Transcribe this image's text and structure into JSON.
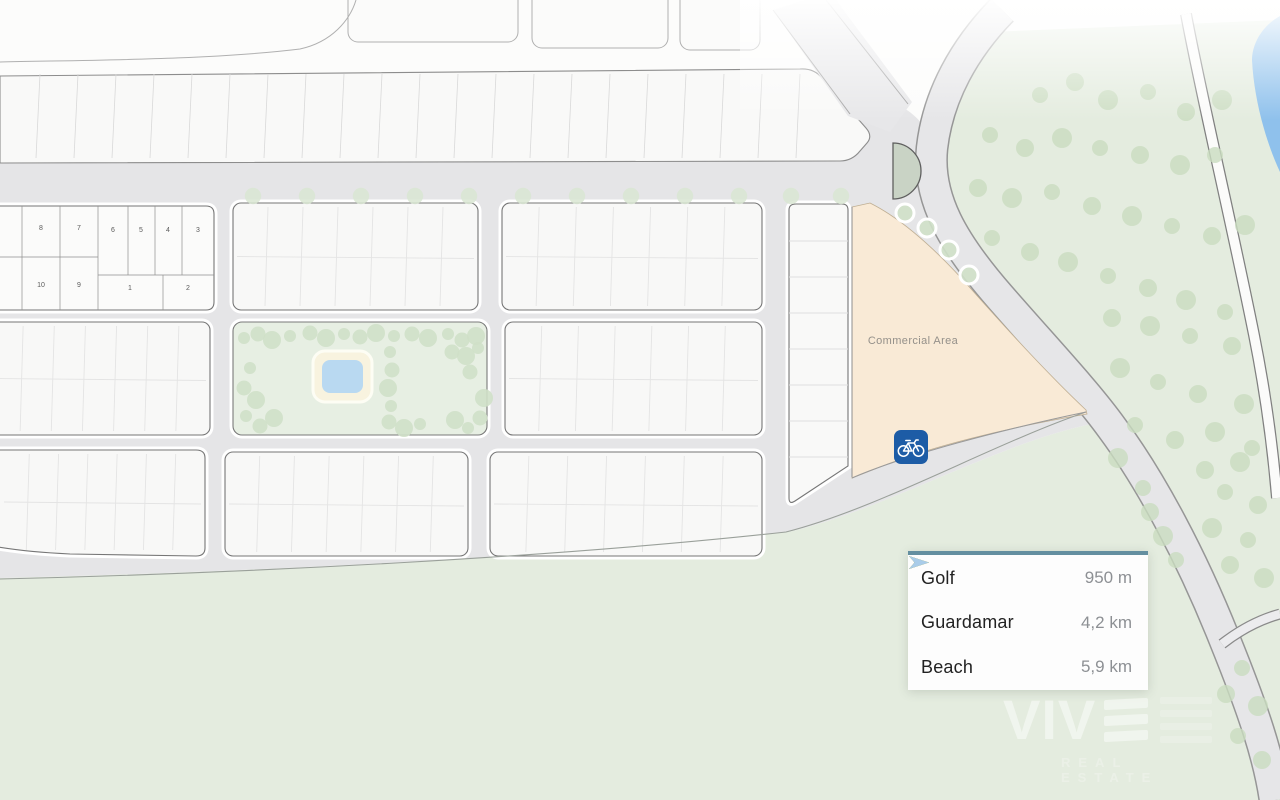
{
  "map": {
    "commercial_area_label": "Commercial Area",
    "plots_block": {
      "top_row": [
        "8",
        "7",
        "6",
        "5",
        "4",
        "3"
      ],
      "bottom_row": [
        "10",
        "9",
        "1",
        "2"
      ]
    },
    "colors": {
      "road_fill": "#e5e5e7",
      "block_fill": "#f8f8f7",
      "park_fill": "#e7efe3",
      "commercial_fill": "#f9ead6",
      "greenery_fill": "#e4ecdf",
      "water_fill": "#8fc1ec",
      "roundabout_fill": "#c9d3c5",
      "pool_fill": "#b9d9f1",
      "pool_deck_fill": "#f8f3df",
      "bike_badge": "#1d5ca6",
      "tree_dot": "#cfe0c8"
    }
  },
  "legend": {
    "accent_color": "#648fa0",
    "items": [
      {
        "label": "Golf",
        "distance": "950 m",
        "color": "#1fae74"
      },
      {
        "label": "Guardamar",
        "distance": "4,2 km",
        "color": "#d49a28"
      },
      {
        "label": "Beach",
        "distance": "5,9 km",
        "color": "#a9cce9"
      }
    ]
  },
  "brand": {
    "name": "VIV",
    "tagline": "REAL ESTATE"
  }
}
